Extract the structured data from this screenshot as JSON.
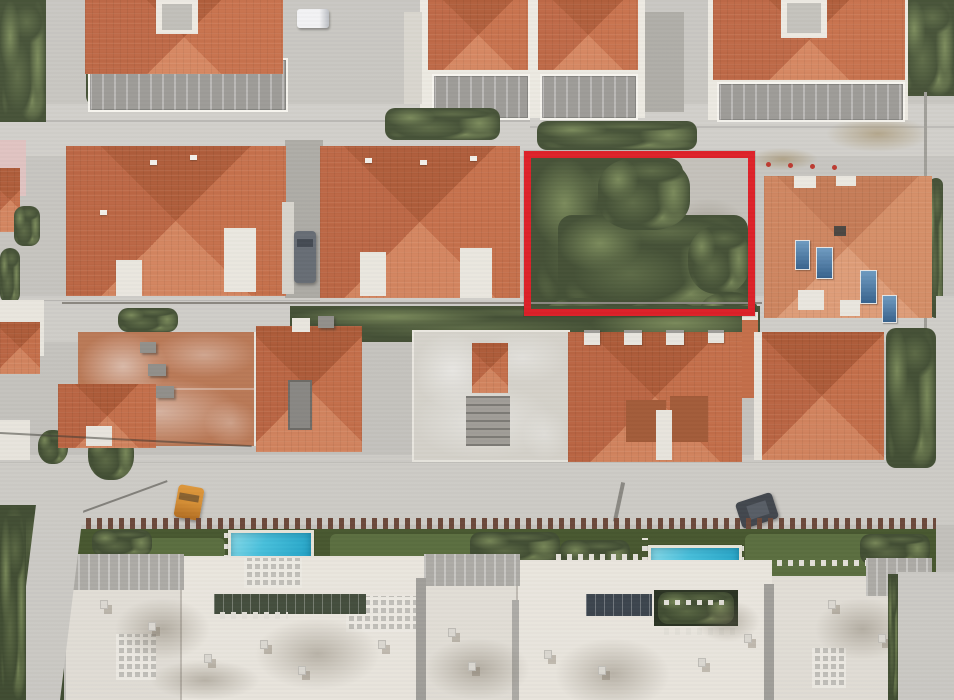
{
  "scene": {
    "type": "aerial-drone-photograph",
    "subject": "Suburban residential block seen from directly overhead: rows of terracotta-roofed villas along two streets, a red-outlined vacant plot densely covered with trees, and a large white apartment complex with gardens and two swimming pools at the bottom",
    "highlight": {
      "name": "red-plot-boundary",
      "shape": "rectangle",
      "stroke_color": "#e41c24",
      "stroke_width_px": 7,
      "contents": "dense tree canopy, bare dirt strip on the left, concrete pavement in the upper-right corner"
    },
    "features": [
      "three white villas with terracotta hip roofs and grey roof terraces (top row)",
      "two large terracotta hip-roof villas (second row, left of highlighted plot)",
      "salmon-roof villa with rooftop solar water heaters (right of highlighted plot)",
      "row of older terracotta-roof houses and one unfinished concrete building (third row)",
      "white apartment complex with flat roofs, vents and shadows (bottom)",
      "two turquoise swimming pools in green gardens",
      "orange parked car on lower street",
      "dark parked cars and a white van",
      "light grey asphalt streets",
      "hedges, groves and garden vegetation"
    ]
  },
  "colors": {
    "street": "#c8c6c1",
    "street-light": "#d2d0cb",
    "asphalt-dark": "#aeaca6",
    "white-wall": "#edeae2",
    "white-bright": "#f7f5ef",
    "white-roof": "#e9e5dd",
    "concrete": "#d9d6ce",
    "terrace": "#9c9a96",
    "facade": "#b2b0ab",
    "roof-n": "#b15a35",
    "roof-e": "#c96f47",
    "roof-s": "#d8855c",
    "roof-w": "#bf6540",
    "roof-pale-n": "#c87a52",
    "roof-pale-e": "#d98e64",
    "roof-pale-s": "#e39d76",
    "roof-pale-w": "#d2855c",
    "roof-weathered": "#bf7a55",
    "roof-brown": "#a85c38",
    "tree": "#5c6a44",
    "tree-dark": "#434f33",
    "tree-light": "#7a8a58",
    "lawn": "#49592f",
    "lawn-light": "#5d7140",
    "dirt": "#b29468",
    "highlight": "#e41c24",
    "pool": "#46c6e4",
    "car-orange": "#dd9232",
    "car-dark": "#43484f",
    "car-gray": "#666c74",
    "fence": "#6f4a3a",
    "pink": "#e3c4c2",
    "solar": "#46503f",
    "panel-blue": "#6d9cc4"
  }
}
